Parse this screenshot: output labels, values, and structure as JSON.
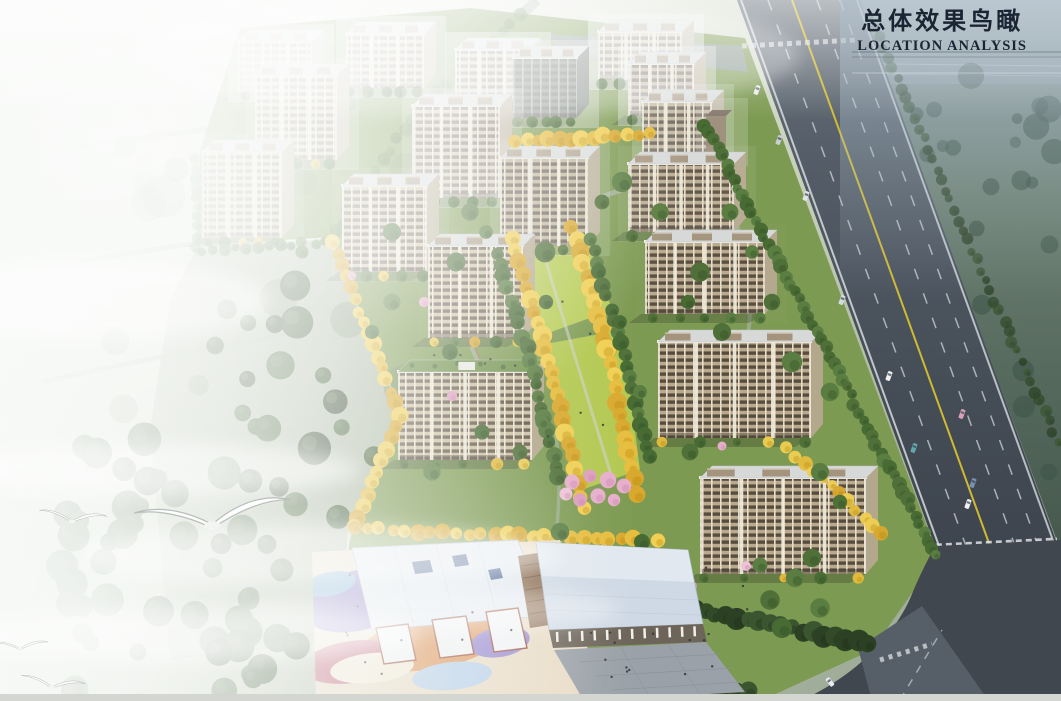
{
  "header": {
    "title": "总体效果鸟瞰",
    "subtitle": "LOCATION ANALYSIS",
    "text_color": "#1b2433"
  },
  "palette": {
    "fog_white": "#f4f6f2",
    "field_green": "#a9b5a0",
    "site_green": "#7d9a52",
    "lawn_bright": "#b7cc55",
    "tree_green": "#4f7038",
    "tree_dark": "#324a28",
    "tree_yellow": "#e3bb3c",
    "tree_pink": "#e2a6c6",
    "facade_tan": "#cdc0a4",
    "facade_brown": "#b9aa8e",
    "window_band": "#574a3a",
    "roof_gray": "#d7d9d9",
    "green_roof": "#6f9048",
    "highway_asphalt": "#49525c",
    "lane_yellow": "#d8c030",
    "far_side_green": "#5d7264",
    "school_roof_blue": "#cfd9e5",
    "playground_purple": "#8b7ac6",
    "playground_orange": "#e09a62",
    "playground_pink": "#c4697f",
    "playground_blue": "#85b4da"
  },
  "scene": {
    "buildings": [
      {
        "x": 238,
        "y": 42,
        "w": 74,
        "h": 50,
        "fog": 0.45,
        "t": "tan"
      },
      {
        "x": 346,
        "y": 34,
        "w": 78,
        "h": 54,
        "fog": 0.42,
        "t": "tan"
      },
      {
        "x": 455,
        "y": 50,
        "w": 74,
        "h": 52,
        "fog": 0.45,
        "t": "tan"
      },
      {
        "x": 598,
        "y": 32,
        "w": 84,
        "h": 48,
        "fog": 0.5,
        "t": "tan"
      },
      {
        "x": 513,
        "y": 58,
        "w": 64,
        "h": 60,
        "fog": 0.32,
        "t": "dark"
      },
      {
        "x": 628,
        "y": 64,
        "w": 66,
        "h": 52,
        "fog": 0.38,
        "t": "brown"
      },
      {
        "x": 255,
        "y": 76,
        "w": 82,
        "h": 84,
        "fog": 0.25,
        "t": "tan"
      },
      {
        "x": 412,
        "y": 106,
        "w": 88,
        "h": 92,
        "fog": 0.25,
        "t": "tan"
      },
      {
        "x": 642,
        "y": 102,
        "w": 70,
        "h": 60,
        "fog": 0.22,
        "t": "brown"
      },
      {
        "x": 706,
        "y": 116,
        "w": 20,
        "h": 40,
        "fog": 0.2,
        "t": "small"
      },
      {
        "x": 202,
        "y": 152,
        "w": 80,
        "h": 86,
        "fog": 0.15,
        "t": "tan"
      },
      {
        "x": 500,
        "y": 158,
        "w": 88,
        "h": 88,
        "fog": 0.15,
        "t": "brown"
      },
      {
        "x": 342,
        "y": 186,
        "w": 85,
        "h": 86,
        "fog": 0.1,
        "t": "tan"
      },
      {
        "x": 628,
        "y": 164,
        "w": 106,
        "h": 68,
        "fog": 0.08,
        "t": "brown"
      },
      {
        "x": 428,
        "y": 246,
        "w": 95,
        "h": 92,
        "fog": 0.04,
        "t": "tan"
      },
      {
        "x": 645,
        "y": 242,
        "w": 120,
        "h": 72,
        "fog": 0.02,
        "t": "brown"
      },
      {
        "x": 658,
        "y": 342,
        "w": 153,
        "h": 96,
        "fog": 0,
        "t": "brown"
      },
      {
        "x": 398,
        "y": 372,
        "w": 134,
        "h": 88,
        "fog": 0,
        "t": "tan",
        "greenRoof": true
      },
      {
        "x": 700,
        "y": 478,
        "w": 166,
        "h": 96,
        "fog": 0,
        "t": "brown"
      }
    ],
    "tree_rows": [
      {
        "pts": [
          [
            520,
            15
          ],
          [
            420,
            110
          ],
          [
            360,
            190
          ],
          [
            336,
            232
          ]
        ],
        "c": "g",
        "r": 6,
        "s": 13,
        "layer": "back",
        "o": 0.6
      },
      {
        "pts": [
          [
            250,
            142
          ],
          [
            352,
            102
          ]
        ],
        "c": "g",
        "r": 6,
        "s": 14,
        "layer": "back",
        "o": 0.55
      },
      {
        "pts": [
          [
            196,
            160
          ],
          [
            197,
            246
          ]
        ],
        "c": "g",
        "r": 5,
        "s": 10,
        "layer": "back",
        "o": 0.7
      },
      {
        "pts": [
          [
            200,
            252
          ],
          [
            326,
            242
          ]
        ],
        "c": "g",
        "r": 5,
        "s": 11,
        "layer": "front",
        "o": 0.85
      },
      {
        "pts": [
          [
            333,
            242
          ],
          [
            400,
            414
          ],
          [
            363,
            505
          ],
          [
            354,
            528
          ]
        ],
        "c": "y",
        "r": 7,
        "s": 12,
        "layer": "front",
        "o": 1
      },
      {
        "pts": [
          [
            354,
            528
          ],
          [
            520,
            536
          ],
          [
            658,
            540
          ]
        ],
        "c": "y",
        "r": 7,
        "s": 13,
        "layer": "front",
        "o": 1
      },
      {
        "pts": [
          [
            705,
            124
          ],
          [
            936,
            556
          ]
        ],
        "c": "g",
        "r": 6,
        "s": 9,
        "layer": "front",
        "o": 1
      },
      {
        "pts": [
          [
            870,
            18
          ],
          [
            1058,
            442
          ]
        ],
        "c": "d",
        "r": 5,
        "s": 11,
        "layer": "front",
        "o": 0.7
      },
      {
        "pts": [
          [
            512,
            238
          ],
          [
            548,
            360
          ],
          [
            574,
            468
          ],
          [
            584,
            510
          ]
        ],
        "c": "y",
        "r": 8,
        "s": 13,
        "layer": "front",
        "o": 1
      },
      {
        "pts": [
          [
            572,
            228
          ],
          [
            608,
            350
          ],
          [
            628,
            452
          ],
          [
            638,
            494
          ]
        ],
        "c": "y",
        "r": 8,
        "s": 13,
        "layer": "front",
        "o": 1
      },
      {
        "pts": [
          [
            496,
            252
          ],
          [
            534,
            372
          ],
          [
            558,
            478
          ]
        ],
        "c": "g",
        "r": 7,
        "s": 12,
        "layer": "front",
        "o": 1
      },
      {
        "pts": [
          [
            590,
            238
          ],
          [
            624,
            356
          ],
          [
            650,
            458
          ]
        ],
        "c": "g",
        "r": 7,
        "s": 12,
        "layer": "front",
        "o": 1
      },
      {
        "pts": [
          [
            516,
            142
          ],
          [
            648,
            134
          ]
        ],
        "c": "y",
        "r": 7,
        "s": 11,
        "layer": "front",
        "o": 1
      },
      {
        "pts": [
          [
            640,
            600
          ],
          [
            760,
            622
          ],
          [
            868,
            644
          ]
        ],
        "c": "d",
        "r": 9,
        "s": 11,
        "layer": "front",
        "o": 1
      },
      {
        "pts": [
          [
            380,
            695
          ],
          [
            560,
            700
          ],
          [
            748,
            690
          ]
        ],
        "c": "d",
        "r": 8,
        "s": 12,
        "layer": "front",
        "o": 1
      },
      {
        "pts": [
          [
            788,
            448
          ],
          [
            882,
            532
          ]
        ],
        "c": "y",
        "r": 6,
        "s": 12,
        "layer": "front",
        "o": 0.95
      }
    ],
    "scatter_trees": {
      "green": [
        [
          470,
          212
        ],
        [
          486,
          232
        ],
        [
          545,
          252
        ],
        [
          456,
          262
        ],
        [
          392,
          302
        ],
        [
          372,
          332
        ],
        [
          450,
          352
        ],
        [
          546,
          302
        ],
        [
          620,
          322
        ],
        [
          688,
          302
        ],
        [
          700,
          272
        ],
        [
          722,
          332
        ],
        [
          640,
          392
        ],
        [
          542,
          422
        ],
        [
          520,
          452
        ],
        [
          482,
          432
        ],
        [
          432,
          472
        ],
        [
          560,
          532
        ],
        [
          642,
          542
        ],
        [
          690,
          452
        ],
        [
          820,
          472
        ],
        [
          840,
          502
        ],
        [
          622,
          182
        ],
        [
          602,
          202
        ],
        [
          660,
          212
        ],
        [
          730,
          212
        ],
        [
          752,
          252
        ],
        [
          772,
          302
        ],
        [
          792,
          362
        ],
        [
          830,
          392
        ],
        [
          392,
          232
        ],
        [
          302,
          252
        ],
        [
          770,
          600
        ],
        [
          795,
          578
        ],
        [
          812,
          558
        ],
        [
          782,
          628
        ],
        [
          820,
          608
        ],
        [
          760,
          565
        ]
      ],
      "pink": [
        [
          572,
          482
        ],
        [
          590,
          476
        ],
        [
          608,
          480
        ],
        [
          624,
          486
        ],
        [
          598,
          496
        ],
        [
          580,
          500
        ],
        [
          614,
          500
        ],
        [
          566,
          494
        ]
      ],
      "pink_small": [
        [
          352,
          276
        ],
        [
          452,
          396
        ],
        [
          722,
          446
        ],
        [
          692,
          586
        ],
        [
          424,
          302
        ],
        [
          746,
          566
        ]
      ]
    },
    "cars": [
      {
        "x": 757,
        "y": 90,
        "rot": 20,
        "c": "#e9ebed"
      },
      {
        "x": 779,
        "y": 140,
        "rot": 20,
        "c": "#c9cfd5"
      },
      {
        "x": 806,
        "y": 196,
        "rot": 20,
        "c": "#e2e5e8"
      },
      {
        "x": 842,
        "y": 300,
        "rot": 20,
        "c": "#d6dadd"
      },
      {
        "x": 889,
        "y": 376,
        "rot": 20,
        "c": "#f0f2f4"
      },
      {
        "x": 914,
        "y": 448,
        "rot": 20,
        "c": "#62a8a8"
      },
      {
        "x": 962,
        "y": 414,
        "rot": 20,
        "c": "#d8a2ba"
      },
      {
        "x": 973,
        "y": 483,
        "rot": 20,
        "c": "#7890b0"
      },
      {
        "x": 968,
        "y": 504,
        "rot": 20,
        "c": "#eff1f3"
      },
      {
        "x": 830,
        "y": 682,
        "rot": -38,
        "c": "#e9edf0"
      }
    ],
    "birds": [
      {
        "x": 212,
        "y": 522,
        "s": 2.4,
        "rot": -4
      },
      {
        "x": 72,
        "y": 520,
        "s": 1.05,
        "rot": 6
      },
      {
        "x": 20,
        "y": 648,
        "s": 0.85,
        "rot": 0
      },
      {
        "x": 52,
        "y": 686,
        "s": 1.0,
        "rot": 8
      }
    ],
    "people_regions": [
      {
        "x": 585,
        "y": 628,
        "w": 128,
        "h": 50,
        "n": 14
      },
      {
        "x": 332,
        "y": 572,
        "w": 200,
        "h": 105,
        "n": 10
      },
      {
        "x": 545,
        "y": 300,
        "w": 58,
        "h": 170,
        "n": 5
      },
      {
        "x": 430,
        "y": 352,
        "w": 90,
        "h": 14,
        "n": 5
      },
      {
        "x": 700,
        "y": 560,
        "w": 60,
        "h": 50,
        "n": 4
      }
    ]
  }
}
